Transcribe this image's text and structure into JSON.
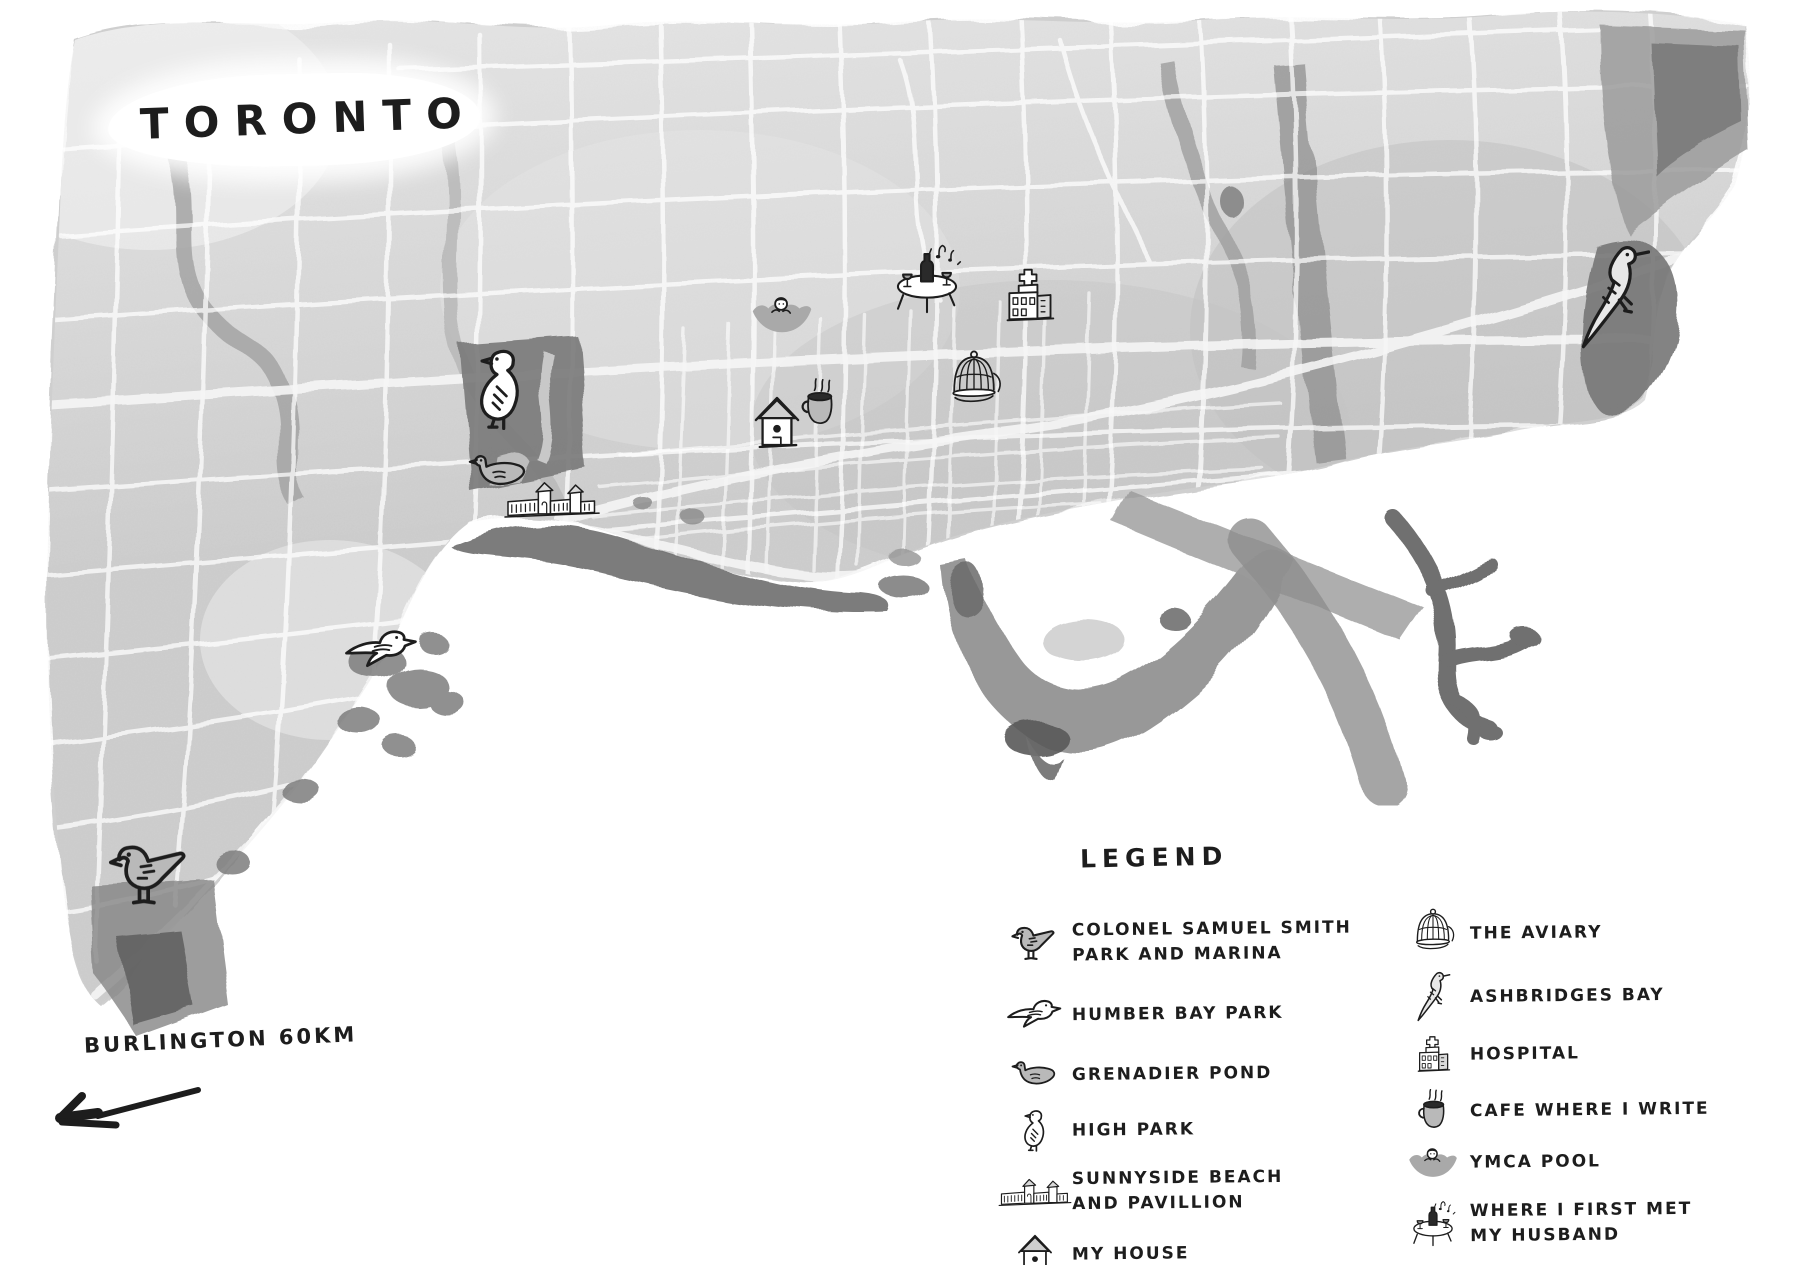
{
  "title": "TORONTO",
  "scale_note": {
    "label": "BURLINGTON 60KM"
  },
  "legend": {
    "title": "LEGEND",
    "col1": [
      {
        "icon": "gull-standing-icon",
        "label": "COLONEL SAMUEL SMITH\nPARK AND MARINA"
      },
      {
        "icon": "flying-bird-icon",
        "label": "HUMBER BAY PARK"
      },
      {
        "icon": "duck-icon",
        "label": "GRENADIER POND"
      },
      {
        "icon": "small-bird-icon",
        "label": "HIGH PARK"
      },
      {
        "icon": "pavilion-icon",
        "label": "SUNNYSIDE BEACH\nAND PAVILLION"
      },
      {
        "icon": "house-icon",
        "label": "MY HOUSE"
      }
    ],
    "col2": [
      {
        "icon": "birdcage-icon",
        "label": "THE AVIARY"
      },
      {
        "icon": "long-tailed-bird-icon",
        "label": "ASHBRIDGES BAY"
      },
      {
        "icon": "hospital-icon",
        "label": "HOSPITAL"
      },
      {
        "icon": "coffee-cup-icon",
        "label": "CAFE WHERE I WRITE"
      },
      {
        "icon": "swimmer-icon",
        "label": "YMCA POOL"
      },
      {
        "icon": "table-icon",
        "label": "WHERE I FIRST MET\nMY HUSBAND"
      }
    ]
  },
  "map": {
    "markers": [
      {
        "place": "Colonel Samuel Smith Park and Marina",
        "icon": "gull-standing-icon"
      },
      {
        "place": "Humber Bay Park",
        "icon": "flying-bird-icon"
      },
      {
        "place": "Grenadier Pond",
        "icon": "duck-icon"
      },
      {
        "place": "High Park",
        "icon": "small-bird-icon"
      },
      {
        "place": "Sunnyside Beach and Pavillion",
        "icon": "pavilion-icon"
      },
      {
        "place": "My House",
        "icon": "house-icon"
      },
      {
        "place": "Cafe Where I Write",
        "icon": "coffee-cup-icon"
      },
      {
        "place": "YMCA Pool",
        "icon": "swimmer-icon"
      },
      {
        "place": "Where I First Met My Husband",
        "icon": "table-icon"
      },
      {
        "place": "Hospital",
        "icon": "hospital-icon"
      },
      {
        "place": "The Aviary",
        "icon": "birdcage-icon"
      },
      {
        "place": "Ashbridges Bay",
        "icon": "long-tailed-bird-icon"
      }
    ]
  },
  "colors": {
    "ink": "#1d1d1d",
    "wash": "#d4d4d4",
    "wash_dark": "#8e8e8e",
    "paper": "#ffffff"
  }
}
